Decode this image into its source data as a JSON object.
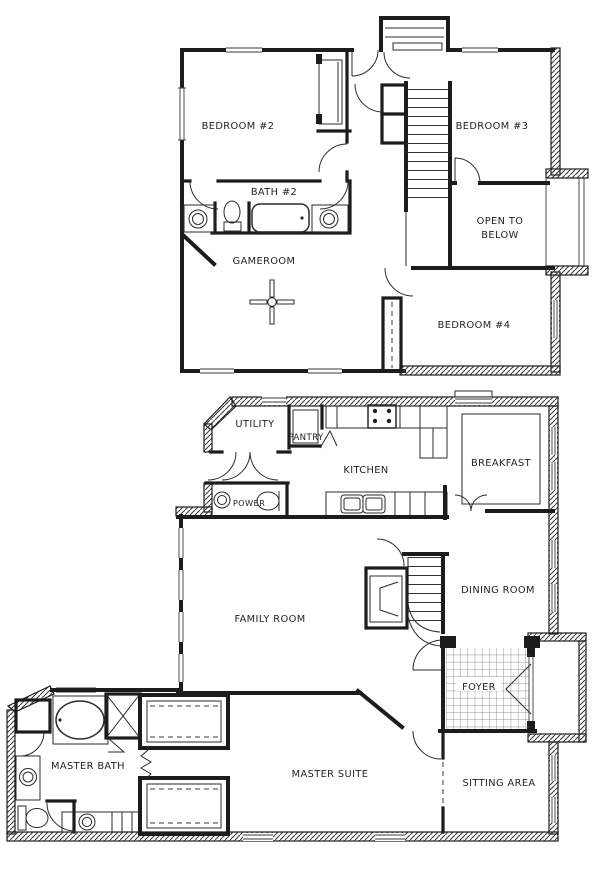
{
  "document": {
    "kind": "two-story residential floor plan",
    "colors": {
      "ink": "#1f1f1f",
      "paper": "#ffffff"
    }
  },
  "upper_floor": {
    "labels": {
      "bedroom2": "BEDROOM #2",
      "bath2": "BATH #2",
      "gameroom": "GAMEROOM",
      "bedroom3": "BEDROOM #3",
      "open_to_below_1": "OPEN TO",
      "open_to_below_2": "BELOW",
      "bedroom4": "BEDROOM #4"
    }
  },
  "lower_floor": {
    "labels": {
      "utility": "UTILITY",
      "pantry": "PANTRY",
      "kitchen": "KITCHEN",
      "breakfast": "BREAKFAST",
      "powder": "POWER",
      "family_room": "FAMILY ROOM",
      "dining_room": "DINING ROOM",
      "foyer": "FOYER",
      "master_bath": "MASTER BATH",
      "master_suite": "MASTER SUITE",
      "sitting_area": "SITTING AREA"
    }
  }
}
